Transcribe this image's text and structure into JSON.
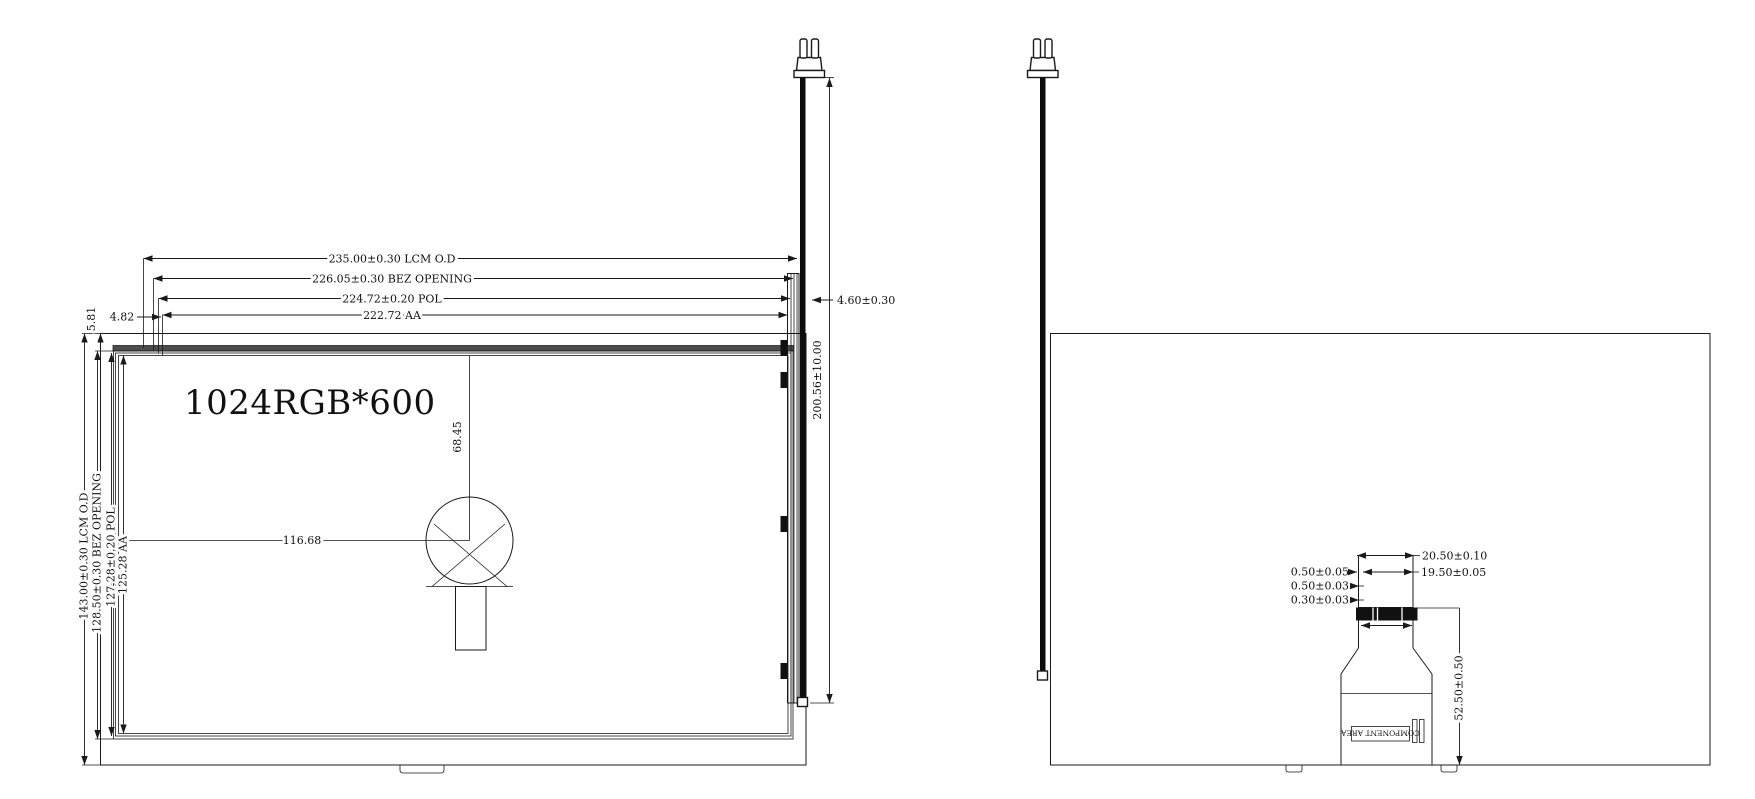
{
  "front_view": {
    "panel_label": "1024RGB*600",
    "dim_width_lcm": "235.00±0.30 LCM O.D",
    "dim_width_bez": "226.05±0.30 BEZ OPENING",
    "dim_width_pol": "224.72±0.20 POL",
    "dim_width_aa": "222.72 AA",
    "dim_height_lcm": "143.00±0.30 LCM O.D",
    "dim_height_bez": "128.50±0.30 BEZ OPENING",
    "dim_height_pol": "127.28±0.20 POL",
    "dim_height_aa": "125.28 AA",
    "dim_top_offset_1": "5.81",
    "dim_top_offset_2": "4.82",
    "dim_center_vertical": "68.45",
    "dim_center_horizontal": "116.68"
  },
  "side_view": {
    "dim_thickness": "4.60±0.30",
    "dim_cable_length": "200.56±10.00"
  },
  "back_view": {
    "dim_fpc_outer_width": "20.50±0.10",
    "dim_fpc_contact_width": "19.50±0.05",
    "dim_fpc_offset_1": "0.50±0.05",
    "dim_fpc_offset_2": "0.50±0.03",
    "dim_fpc_offset_3": "0.30±0.03",
    "dim_fpc_length": "52.50±0.50",
    "component_area_label": "COMPONENT AREA"
  },
  "colors": {
    "line": "#1a1a1a",
    "dark_fill": "#111111",
    "bezel_band": "#4d4d4d"
  }
}
